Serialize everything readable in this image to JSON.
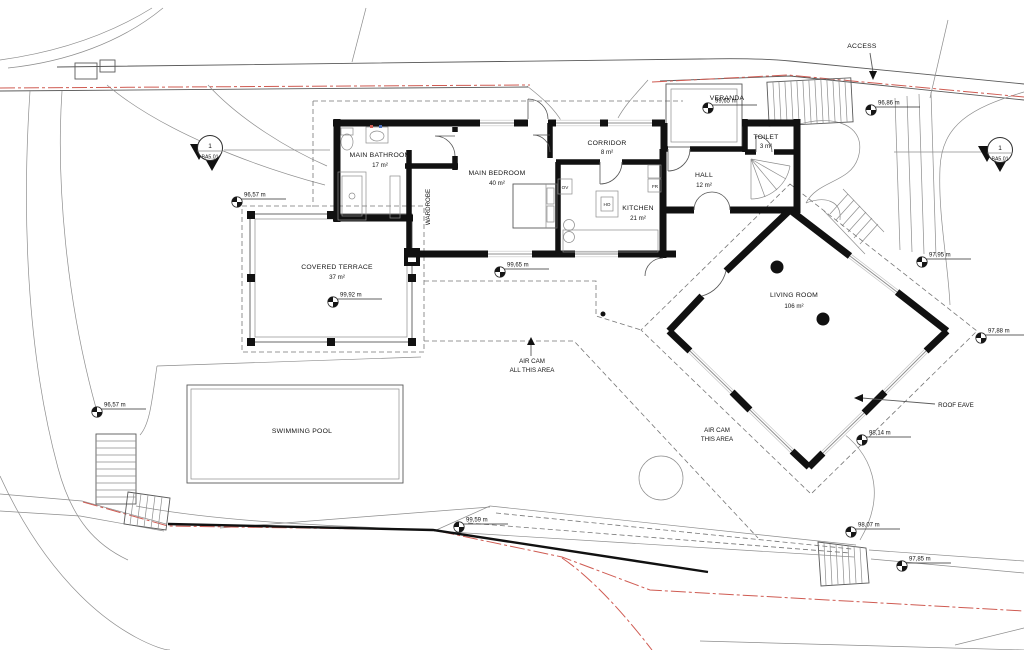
{
  "rooms": [
    {
      "name": "MAIN BATHROOM",
      "area": "17 m²"
    },
    {
      "name": "WARDROBE",
      "area": ""
    },
    {
      "name": "MAIN BEDROOM",
      "area": "40 m²"
    },
    {
      "name": "CORRIDOR",
      "area": "8 m²"
    },
    {
      "name": "KITCHEN",
      "area": "21 m²"
    },
    {
      "name": "HALL",
      "area": "12 m²"
    },
    {
      "name": "TOILET",
      "area": "3 m²"
    },
    {
      "name": "VERANDA",
      "area": ""
    },
    {
      "name": "COVERED TERRACE",
      "area": "37 m²"
    },
    {
      "name": "LIVING ROOM",
      "area": "106 m²"
    },
    {
      "name": "SWIMMING POOL",
      "area": ""
    }
  ],
  "annotations": {
    "access": "ACCESS",
    "roof_eave": "ROOF EAVE",
    "air_cam_all": [
      "AIR CAM",
      "ALL THIS AREA"
    ],
    "air_cam_this": [
      "AIR CAM",
      "THIS AREA"
    ]
  },
  "appliances": {
    "oven": "OV",
    "hob": "HO",
    "fridge": "FR"
  },
  "section_marker": {
    "number": "1",
    "sheet": "BA5.01"
  },
  "elevations": [
    {
      "value": "96,86 m",
      "x": 871,
      "y": 110
    },
    {
      "value": "99,65 m",
      "x": 708,
      "y": 108
    },
    {
      "value": "96,57 m",
      "x": 237,
      "y": 202
    },
    {
      "value": "99,92 m",
      "x": 333,
      "y": 302
    },
    {
      "value": "99,65 m",
      "x": 500,
      "y": 272
    },
    {
      "value": "97,95 m",
      "x": 922,
      "y": 262
    },
    {
      "value": "97,88 m",
      "x": 981,
      "y": 338
    },
    {
      "value": "98,14 m",
      "x": 862,
      "y": 440
    },
    {
      "value": "96,57 m",
      "x": 97,
      "y": 412
    },
    {
      "value": "99,59 m",
      "x": 459,
      "y": 527
    },
    {
      "value": "98,07 m",
      "x": 851,
      "y": 532
    },
    {
      "value": "97,85 m",
      "x": 902,
      "y": 566
    }
  ],
  "colors": {
    "wall": "#111111",
    "line": "#5a5a5a",
    "thin": "#8d8d8d",
    "dash": "#767676",
    "red": "#cf5b52",
    "paper": "#ffffff"
  }
}
